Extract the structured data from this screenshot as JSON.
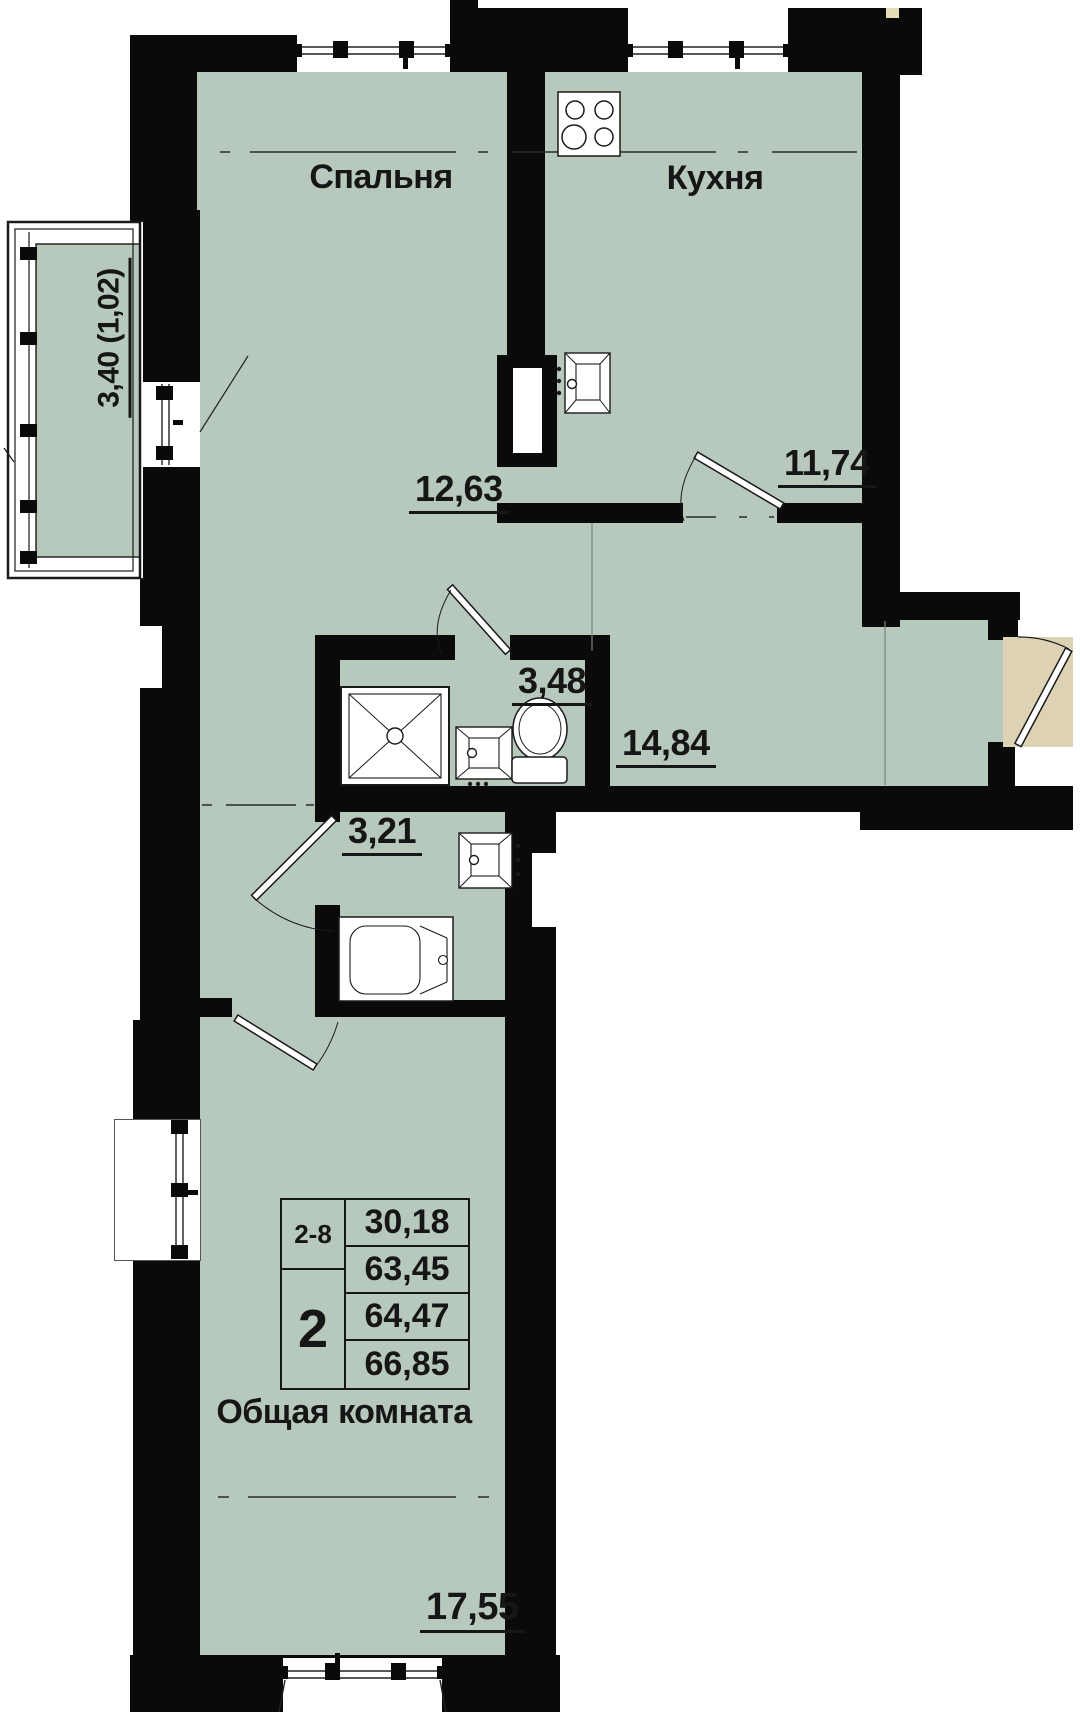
{
  "rooms": {
    "bedroom": {
      "name": "Спальня",
      "area": "12,63"
    },
    "kitchen": {
      "name": "Кухня",
      "area": "11,74"
    },
    "bathroom": {
      "area": "3,48"
    },
    "hallway": {
      "area": "14,84"
    },
    "wc": {
      "area": "3,21"
    },
    "living_room": {
      "name": "Общая комната",
      "area": "17,55"
    },
    "balcony": {
      "dimension": "3,40 (1,02)"
    }
  },
  "stamp": {
    "position_range": "2-8",
    "rooms_count": "2",
    "areas": [
      "30,18",
      "63,45",
      "64,47",
      "66,85"
    ]
  },
  "colors": {
    "room_fill": "#b7c8bc",
    "wall": "#0a0a0a",
    "entry_swing": "#ddd3b4"
  }
}
